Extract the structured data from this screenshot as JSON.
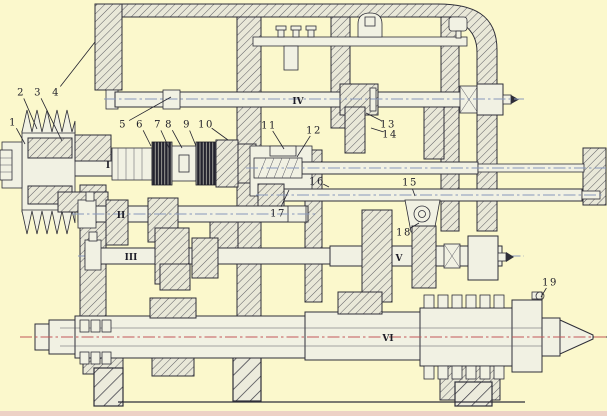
{
  "figure": {
    "type": "engineering-sectional-drawing",
    "subject": "machine tool gearbox (headstock) developed section with six shafts",
    "background_color": "#fbf8cc",
    "line_color": "#2e2e38",
    "centerline_blue": "#8898bb",
    "centerline_red": "#c25858",
    "bottom_scan_edge_color": "#e5b8c0"
  },
  "part_labels": [
    {
      "id": "1",
      "x": 13,
      "y": 122,
      "tx": 25,
      "ty": 144
    },
    {
      "id": "2",
      "x": 21,
      "y": 92,
      "tx": 37,
      "ty": 129
    },
    {
      "id": "3",
      "x": 38,
      "y": 92,
      "tx": 62,
      "ty": 141
    },
    {
      "id": "4",
      "x": 56,
      "y": 92,
      "tx": 95,
      "ty": 42
    },
    {
      "id": "5",
      "x": 123,
      "y": 124,
      "tx": 171,
      "ty": 97
    },
    {
      "id": "6",
      "x": 140,
      "y": 124,
      "tx": 151,
      "ty": 146
    },
    {
      "id": "7",
      "x": 158,
      "y": 124,
      "tx": 169,
      "ty": 148
    },
    {
      "id": "8",
      "x": 169,
      "y": 124,
      "tx": 182,
      "ty": 148
    },
    {
      "id": "9",
      "x": 187,
      "y": 124,
      "tx": 196,
      "ty": 146
    },
    {
      "id": "10",
      "x": 206,
      "y": 124,
      "tx": 228,
      "ty": 140
    },
    {
      "id": "11",
      "x": 269,
      "y": 125,
      "tx": 284,
      "ty": 149
    },
    {
      "id": "12",
      "x": 314,
      "y": 130,
      "tx": 297,
      "ty": 157
    },
    {
      "id": "13",
      "x": 388,
      "y": 124,
      "tx": 366,
      "ty": 113
    },
    {
      "id": "14",
      "x": 390,
      "y": 134,
      "tx": 371,
      "ty": 128
    },
    {
      "id": "15",
      "x": 410,
      "y": 182,
      "tx": 415,
      "ty": 196
    },
    {
      "id": "16",
      "x": 317,
      "y": 181,
      "tx": 329,
      "ty": 187
    },
    {
      "id": "17",
      "x": 278,
      "y": 213,
      "tx": 289,
      "ty": 190
    },
    {
      "id": "18",
      "x": 404,
      "y": 232,
      "tx": 419,
      "ty": 223
    },
    {
      "id": "19",
      "x": 550,
      "y": 282,
      "tx": 541,
      "ty": 297
    }
  ],
  "shaft_labels": [
    {
      "id": "I",
      "x": 108,
      "y": 165
    },
    {
      "id": "II",
      "x": 121,
      "y": 215
    },
    {
      "id": "III",
      "x": 131,
      "y": 257
    },
    {
      "id": "IV",
      "x": 298,
      "y": 101
    },
    {
      "id": "V",
      "x": 399,
      "y": 258
    },
    {
      "id": "VI",
      "x": 388,
      "y": 338
    }
  ]
}
